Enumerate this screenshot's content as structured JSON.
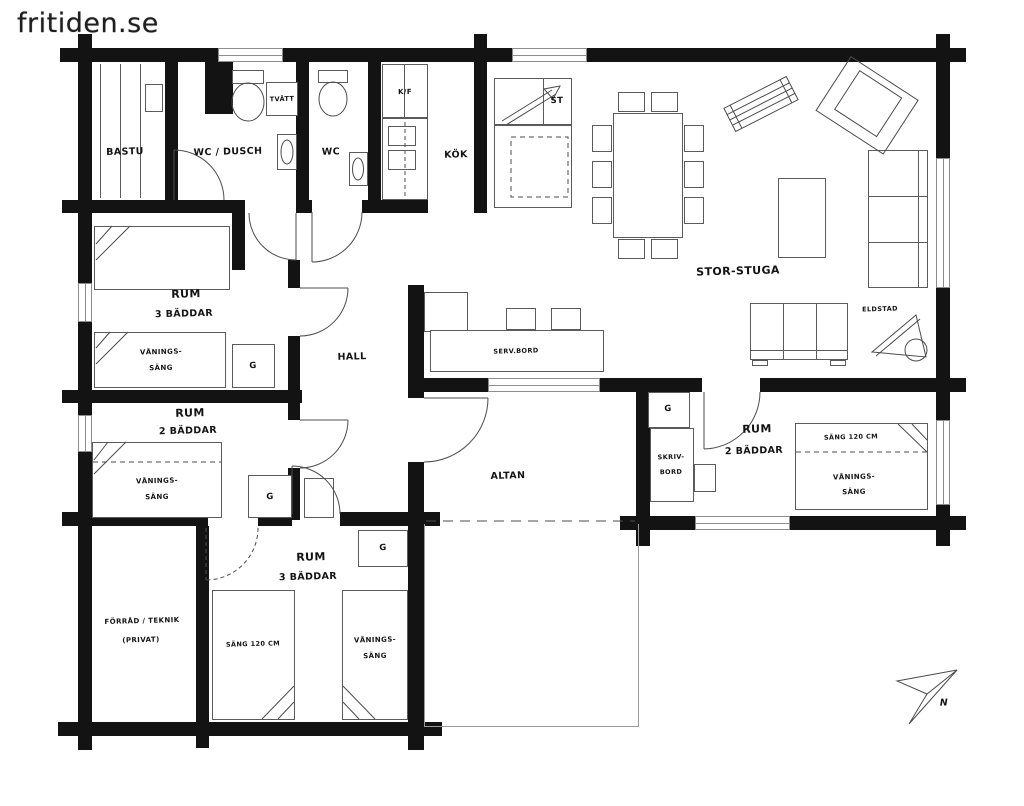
{
  "watermark": "fritiden.se",
  "rooms": {
    "bastu": "BASTU",
    "wc_dusch": "WC / DUSCH",
    "wc": "WC",
    "kok": "KÖK",
    "hall": "HALL",
    "storstuga": "STOR-STUGA",
    "altan": "ALTAN",
    "rum1": {
      "name": "RUM",
      "beds": "3 BÄDDAR"
    },
    "rum2": {
      "name": "RUM",
      "beds": "2 BÄDDAR"
    },
    "rum3": {
      "name": "RUM",
      "beds": "3 BÄDDAR"
    },
    "rum4": {
      "name": "RUM",
      "beds": "2 BÄDDAR"
    },
    "forrad": {
      "line1": "FÖRRÅD / TEKNIK",
      "line2": "(PRIVAT)"
    }
  },
  "furniture": {
    "tvatt": "TVÄTT",
    "kf": "K/F",
    "st": "ST",
    "eldstad": "ELDSTAD",
    "servbord": "SERV.BORD",
    "garderob": "G",
    "vanings_line1": "VÅNINGS-",
    "vanings_line2": "SÄNG",
    "sang120": "SÄNG 120 CM",
    "skriv_line1": "SKRIV-",
    "skriv_line2": "BORD"
  },
  "compass": {
    "north": "N"
  },
  "colors": {
    "wall": "#131313",
    "line": "#5b5b5b",
    "text": "#141414"
  }
}
